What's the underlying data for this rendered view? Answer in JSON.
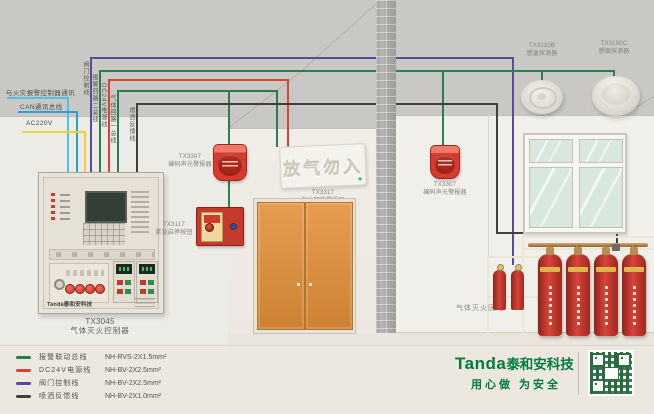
{
  "colors": {
    "fire_comm_wire": "#4ac2ee",
    "can_bus_wire": "#2d9fd6",
    "ac220_wire": "#eed23e",
    "valve_control_wire": "#584b9e",
    "alarm_bus_wire": "#2e7d4f",
    "dc24v_wire": "#d64437",
    "spray_feedback_wire": "#42413d",
    "brand_green": "#007a3d",
    "door_orange": "#d88f3f",
    "device_red": "#d63b2d"
  },
  "wire_labels": {
    "fire_comm": "与火灾报警控制器通讯",
    "can_bus": "CAN通讯总线",
    "ac220": "AC220V",
    "valve_control": "阀门控制线",
    "alarm_bus": "报警回路二总线",
    "dc24v": "DC24V电源线",
    "gas_bus": "气体回路一总线",
    "spray_feedback": "喷洒反馈线"
  },
  "panel": {
    "model": "TX3045",
    "name": "气体灭火控制器",
    "brand": "Tanda泰和安科技"
  },
  "devices": {
    "left_sounder": {
      "model": "TX3307",
      "name": "编码声光警报器"
    },
    "emergency_button": {
      "model": "TX3117",
      "name": "紧急启停按钮"
    },
    "gas_release_sign": {
      "model": "TX3317",
      "name": "气体释放警报器",
      "sign_text": "放气勿入"
    },
    "right_sounder": {
      "model": "TX3307",
      "name": "编码声光警报器"
    },
    "heat_detector": {
      "model": "TX3110B",
      "name": "感温探测器"
    },
    "smoke_detector": {
      "model": "TX3100C",
      "name": "感烟探测器"
    }
  },
  "zone_label": "气体灭火区域",
  "legend": {
    "items": [
      {
        "label": "报警联动总线",
        "spec": "NH-RVS-2X1.5mm²",
        "color": "#2e7d4f"
      },
      {
        "label": "DC24V电源线",
        "spec": "NH-BV-2X2.5mm²",
        "color": "#d64437"
      },
      {
        "label": "阀门控制线",
        "spec": "NH-BV-2X2.5mm²",
        "color": "#584b9e"
      },
      {
        "label": "喷洒反馈线",
        "spec": "NH-BV-2X1.0mm²",
        "color": "#42413d"
      }
    ]
  },
  "branding": {
    "logo": "Tanda",
    "company": "泰和安科技",
    "slogan": "用心做 为安全"
  }
}
